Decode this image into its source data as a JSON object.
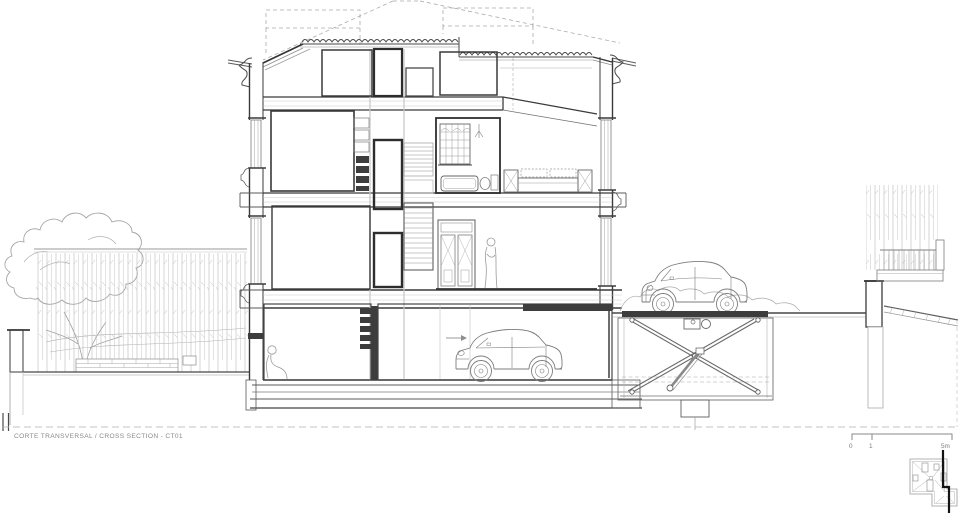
{
  "drawing": {
    "title": "CORTE TRANSVERSAL / CROSS SECTION - CT01",
    "scale_bar": {
      "labels": [
        "0",
        "1",
        "5m"
      ]
    }
  },
  "colors": {
    "paper": "#ffffff",
    "ink_dark": "#3a3a3a",
    "ink_mid": "#6f6f6f",
    "ink_light": "#a9a9a9",
    "vegetation": "#b9b9b9",
    "section_cut_line": "#141414"
  }
}
